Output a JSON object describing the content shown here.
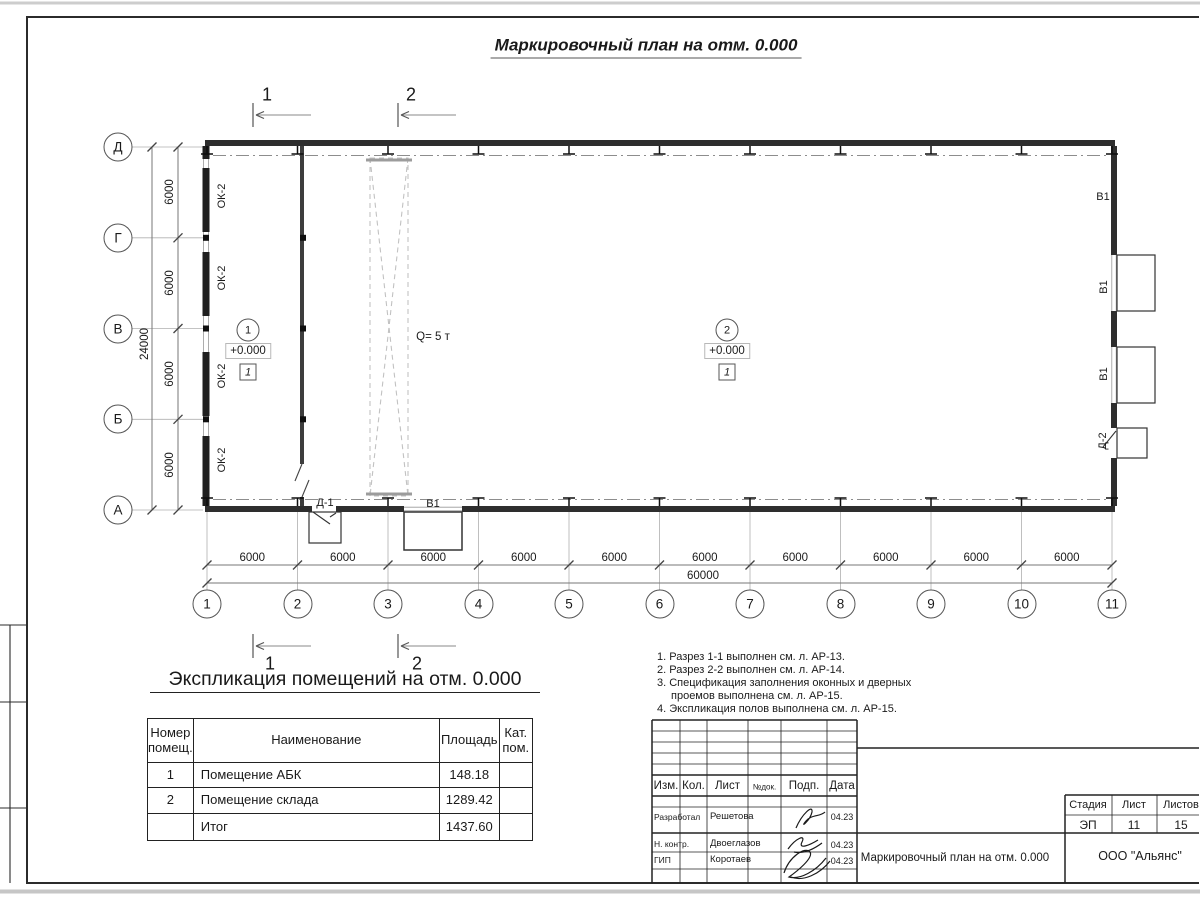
{
  "title": "Маркировочный план на отм. 0.000",
  "plan": {
    "sections": {
      "s1": "1",
      "s2": "2"
    },
    "grid_rows": [
      "Д",
      "Г",
      "В",
      "Б",
      "А"
    ],
    "grid_cols": [
      "1",
      "2",
      "3",
      "4",
      "5",
      "6",
      "7",
      "8",
      "9",
      "10",
      "11"
    ],
    "dims": {
      "bay": "6000",
      "total_w": "60000",
      "total_h": "24000"
    },
    "labels": {
      "window": "ОК-2",
      "door1": "Д-1",
      "door2": "Д-2",
      "gate": "В1",
      "crane": "Q= 5 т"
    },
    "rooms": [
      {
        "num": "1",
        "elev": "+0.000",
        "floor": "1"
      },
      {
        "num": "2",
        "elev": "+0.000",
        "floor": "1"
      }
    ]
  },
  "explication": {
    "heading": "Экспликация помещений на отм. 0.000",
    "headers": {
      "num": [
        "Номер",
        "помещ."
      ],
      "name": "Наименование",
      "area": "Площадь",
      "cat": [
        "Кат.",
        "пом."
      ]
    },
    "rows": [
      {
        "num": "1",
        "name": "Помещение АБК",
        "area": "148.18",
        "cat": ""
      },
      {
        "num": "2",
        "name": "Помещение склада",
        "area": "1289.42",
        "cat": ""
      },
      {
        "num": "",
        "name": "Итог",
        "area": "1437.60",
        "cat": ""
      }
    ]
  },
  "notes": {
    "lines": [
      "1. Разрез 1-1 выполнен см. л. АР-13.",
      "2. Разрез 2-2 выполнен см. л. АР-14.",
      "3. Спецификация заполнения оконных и дверных",
      "проемов выполнена см. л. АР-15.",
      "4. Экспликация полов выполнена см. л. АР-15."
    ]
  },
  "stamp": {
    "cols": {
      "izm": "Изм.",
      "kol": "Кол.",
      "list": "Лист",
      "ndoc": "№док.",
      "podp": "Подп.",
      "data": "Дата"
    },
    "rows": [
      {
        "role": "Разработал",
        "name": "Решетова",
        "date": "04.23"
      },
      {
        "role": "Н. контр.",
        "name": "Двоеглазов",
        "date": "04.23"
      },
      {
        "role": "ГИП",
        "name": "Коротаев",
        "date": "04.23"
      }
    ],
    "doc_title": "Маркировочный план на отм. 0.000",
    "company": "ООО \"Альянс\"",
    "stage_label": "Стадия",
    "sheet_label": "Лист",
    "sheets_label": "Листов",
    "stage": "ЭП",
    "sheet": "11",
    "sheets": "15"
  }
}
